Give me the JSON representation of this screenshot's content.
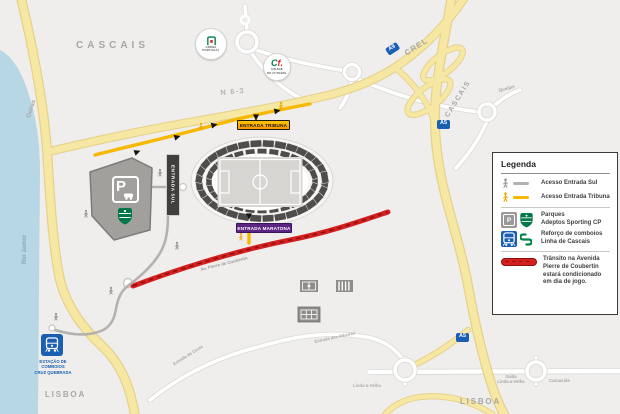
{
  "map": {
    "labels": {
      "cascais_nw": "CASCAIS",
      "cascais_highway": "CASCAIS",
      "oeiras": "Oeiras",
      "rio_jamor": "Rio Jamor",
      "n63": "N 6-3",
      "crel": "CREL",
      "a9": "A9",
      "a5_north": "A5",
      "a5_south": "A5",
      "queijas": "Queijas",
      "lisboa_sw": "LISBOA",
      "lisboa_se": "LISBOA",
      "estrada_costa": "Estrada da Costa",
      "estrada_ribeiras": "Estrada das Ribeiras",
      "av_pierre_coubertin": "Av. Pierre de Coubertin",
      "saida_linda": "Saída\nLinda-a-Velha",
      "carnaxide": "Carnaxide",
      "linda_a_velha": "Linda-a-Velha"
    },
    "badges": {
      "entrada_tribuna": "ENTRADA TRIBUNA",
      "entrada_maratona": "ENTRADA MARATONA",
      "entrada_sul": "ENTRADA SUL"
    },
    "poi": {
      "arena": {
        "line1": "ARENA",
        "line2": "PORTUGAL"
      },
      "cidade_futebol": {
        "c": "C",
        "f": "f.",
        "line1": "CIDADE",
        "line2": "DO FUTEBOL"
      },
      "station": {
        "label": "ESTAÇÃO DE\nCOMBOIOS\nCRUZ QUEBRADA"
      },
      "parking_letter": "P"
    }
  },
  "legend": {
    "title": "Legenda",
    "items": [
      {
        "id": "acesso-entrada-sul",
        "label": "Acesso Entrada Sul"
      },
      {
        "id": "acesso-entrada-tribuna",
        "label": "Acesso Entrada Tribuna"
      },
      {
        "id": "parques",
        "label": "Parques\nAdeptos Sporting CP"
      },
      {
        "id": "comboios",
        "label": "Reforço de comboios\nLinha de Cascais"
      },
      {
        "id": "transito",
        "label": "Trânsito na Avenida\nPierre de Coubertin\nestará condicionado\nem dia de jogo."
      }
    ]
  },
  "colors": {
    "water": "#b7d7e4",
    "road_yellow": "#f6e7a2",
    "access_yellow": "#f6b800",
    "access_gray": "#b4b2af",
    "restricted_red": "#d61f1f",
    "motorway_badge_blue": "#1b5fb3",
    "entrance_tribuna_yellow": "#ffb000",
    "entrance_maratona_purple": "#5c2483",
    "entrance_sul_dark": "#413f3d",
    "sporting_green": "#007749"
  }
}
